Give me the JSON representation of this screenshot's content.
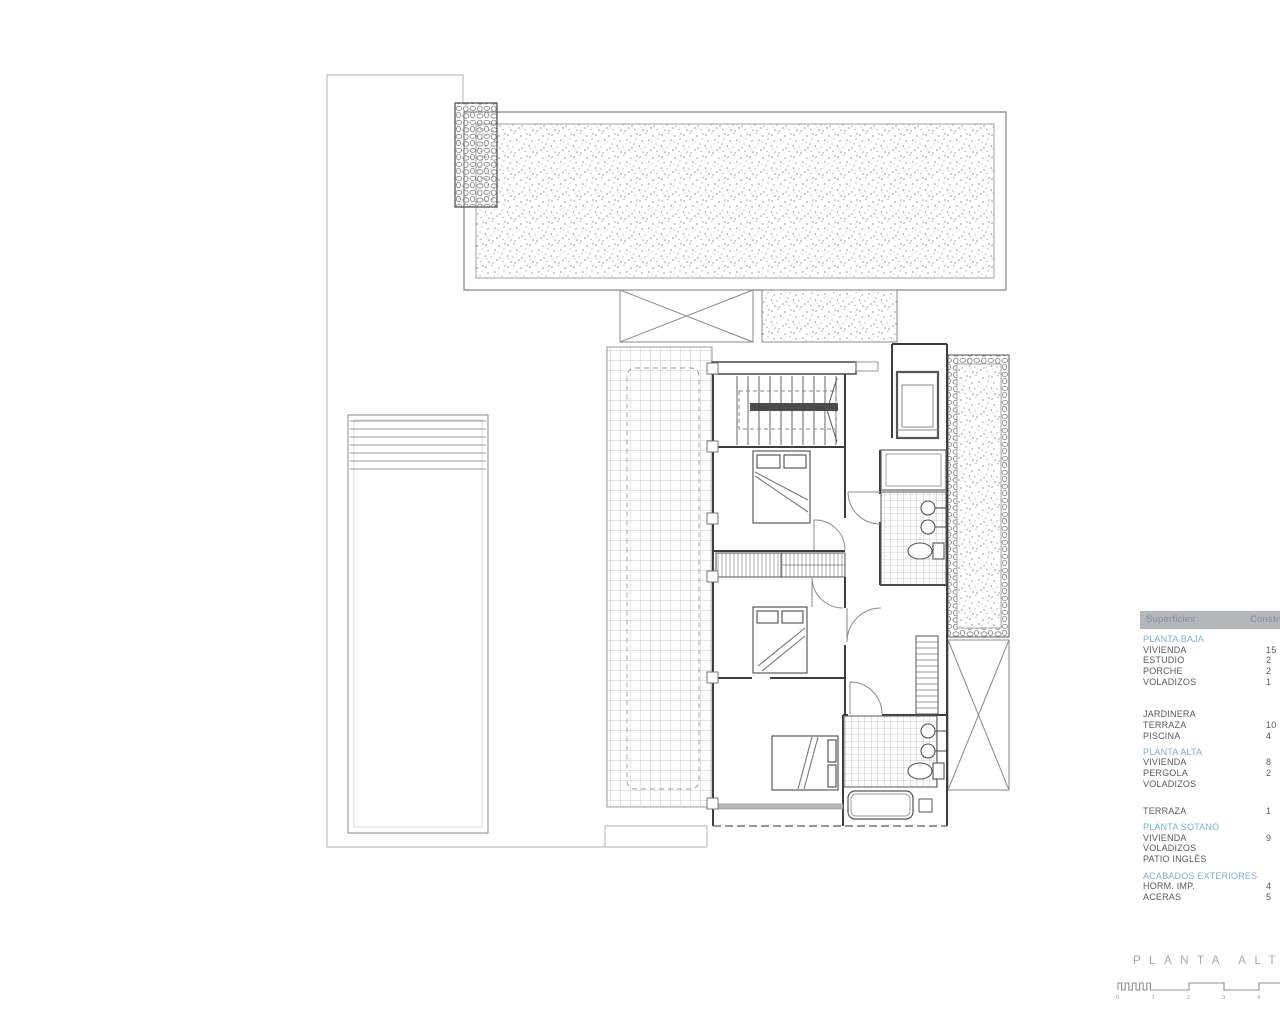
{
  "header": {
    "col_superficies": "Superficies",
    "col_construida": "Constru"
  },
  "table": {
    "rows": [
      {
        "label": "PLANTA BAJA",
        "value": ""
      },
      {
        "label": "VIVIENDA",
        "value": "15"
      },
      {
        "label": "ESTUDIO",
        "value": "2"
      },
      {
        "label": "PORCHE",
        "value": "2"
      },
      {
        "label": "VOLADIZOS",
        "value": "1"
      },
      {
        "label": "JARDINERA",
        "value": ""
      },
      {
        "label": "TERRAZA",
        "value": "10"
      },
      {
        "label": "PISCINA",
        "value": "4"
      },
      {
        "label": "PLANTA ALTA",
        "value": ""
      },
      {
        "label": "VIVIENDA",
        "value": "8"
      },
      {
        "label": "PERGOLA",
        "value": "2"
      },
      {
        "label": "VOLADIZOS",
        "value": ""
      },
      {
        "label": "TERRAZA",
        "value": "1"
      },
      {
        "label": "PLANTA SOTANO",
        "value": ""
      },
      {
        "label": "VIVIENDA",
        "value": "9"
      },
      {
        "label": "VOLADIZOS",
        "value": ""
      },
      {
        "label": "PATIO INGLÉS",
        "value": ""
      },
      {
        "label": "ACABADOS EXTERIORES",
        "value": ""
      },
      {
        "label": "HORM. IMP.",
        "value": "4"
      },
      {
        "label": "ACERAS",
        "value": "5"
      }
    ]
  },
  "footer": {
    "plan_title": "PLANTA ALTA"
  },
  "scalebar": {
    "ticks": [
      "0",
      "1",
      "2",
      "3",
      "4"
    ]
  },
  "colors": {
    "section_blue": "#79b1ce",
    "body_text": "#58595b",
    "header_bg": "#b5b8bb",
    "line_dark": "#3d3d3d",
    "line_light": "#999999",
    "boundary": "#bdbdbd"
  }
}
